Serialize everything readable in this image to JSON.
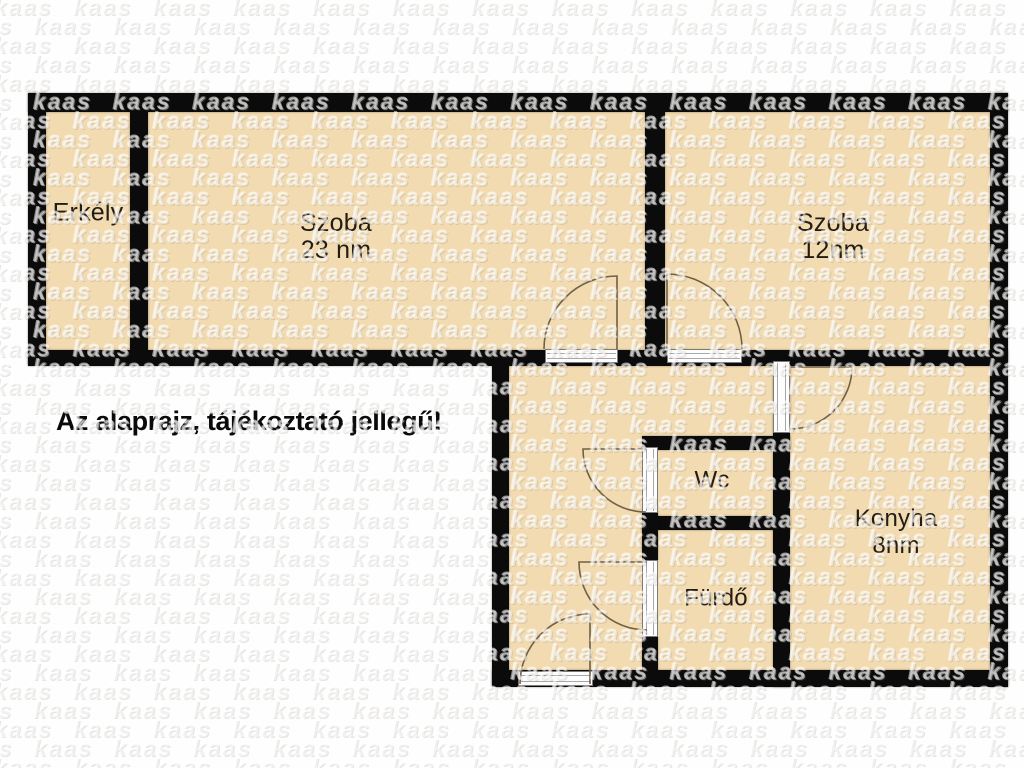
{
  "watermark": {
    "text": "kaas"
  },
  "disclaimer": "Az alaprajz, tájékoztató jellegű!",
  "rooms": {
    "balcony": {
      "label": "Erkély"
    },
    "room1": {
      "label": "Szoba",
      "area": "23 nm"
    },
    "room2": {
      "label": "Szoba",
      "area": "12nm"
    },
    "wc": {
      "label": "Wc"
    },
    "bathroom": {
      "label": "Fürdő"
    },
    "kitchen": {
      "label": "Konyha",
      "area": "8nm"
    }
  },
  "colors": {
    "room_fill": "#f2dbb1",
    "wall": "#0b0b0b",
    "door_arc": "#6f6048",
    "label_text": "#211c15"
  }
}
